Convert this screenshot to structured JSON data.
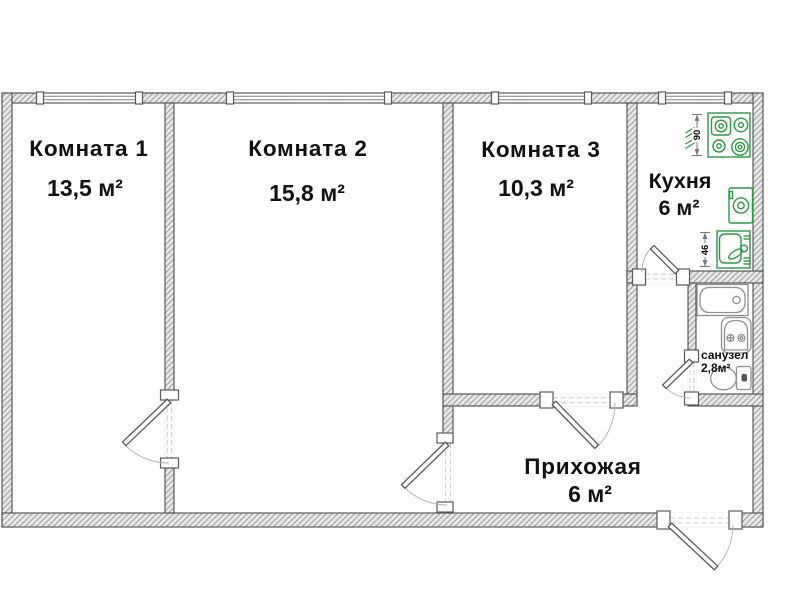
{
  "plan": {
    "rooms": [
      {
        "name": "Комната 1",
        "area": "13,5 м²"
      },
      {
        "name": "Комната 2",
        "area": "15,8 м²"
      },
      {
        "name": "Комната 3",
        "area": "10,3 м²"
      },
      {
        "name": "Кухня",
        "area": "6 м²"
      },
      {
        "name": "Прихожая",
        "area": "6 м²"
      },
      {
        "name": "санузел",
        "area": "2,8м²"
      }
    ],
    "dimension_labels": {
      "stove_width": "90",
      "sink_width": "46"
    },
    "colors": {
      "fixture_green": "#2a9940",
      "wall_outline": "#4d4d4d",
      "fixture_gray": "#8f8f8f",
      "text": "#111111"
    }
  }
}
